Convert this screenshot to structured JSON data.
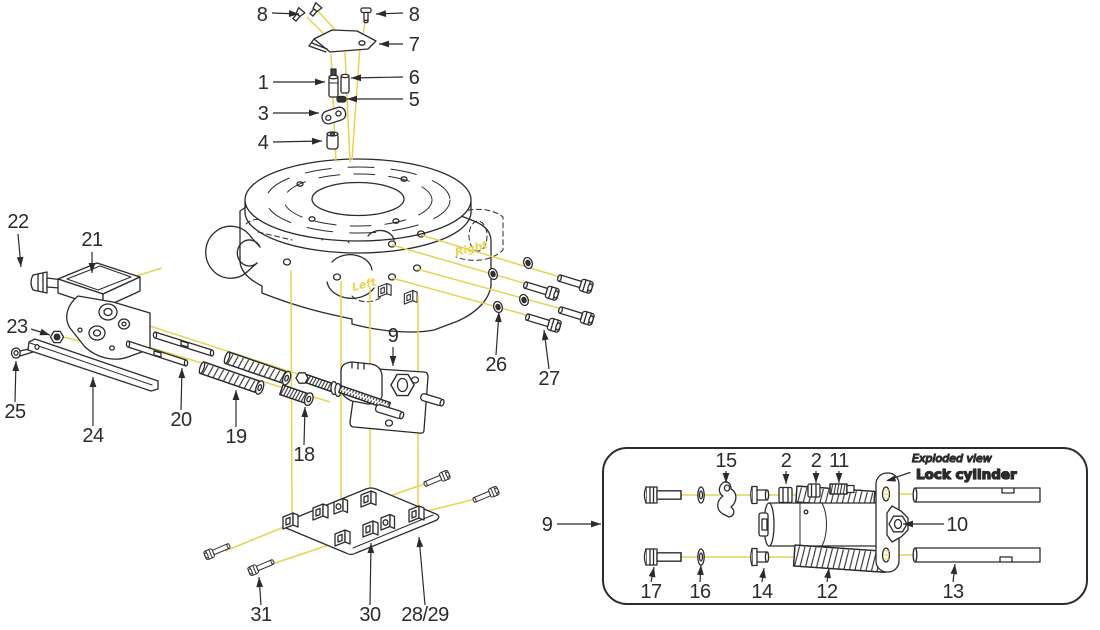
{
  "colors": {
    "ink": "#2b2b2b",
    "accent": "#e6d355"
  },
  "annotations": {
    "exploded_view": "Exploded view",
    "lock_cylinder": "Lock cylinder",
    "right": "Right",
    "left": "Left"
  },
  "part_labels": [
    {
      "text": "8",
      "tx": 262,
      "ty": 21,
      "lx": 272,
      "ly": 13,
      "ax": 299,
      "ay": 14
    },
    {
      "text": "8",
      "tx": 414,
      "ty": 21,
      "lx": 403,
      "ly": 13,
      "ax": 376,
      "ay": 14
    },
    {
      "text": "7",
      "tx": 414,
      "ty": 51,
      "lx": 403,
      "ly": 44,
      "ax": 379,
      "ay": 44
    },
    {
      "text": "1",
      "tx": 263,
      "ty": 89,
      "lx": 273,
      "ly": 82,
      "ax": 325,
      "ay": 82
    },
    {
      "text": "6",
      "tx": 414,
      "ty": 84,
      "lx": 403,
      "ly": 77,
      "ax": 351,
      "ay": 78
    },
    {
      "text": "5",
      "tx": 414,
      "ty": 106,
      "lx": 403,
      "ly": 99,
      "ax": 347,
      "ay": 99
    },
    {
      "text": "3",
      "tx": 263,
      "ty": 120,
      "lx": 273,
      "ly": 113,
      "ax": 319,
      "ay": 113
    },
    {
      "text": "4",
      "tx": 263,
      "ty": 149,
      "lx": 273,
      "ly": 142,
      "ax": 322,
      "ay": 141
    },
    {
      "text": "22",
      "tx": 18,
      "ty": 228,
      "lx": 18,
      "ly": 234,
      "ax": 21,
      "ay": 267
    },
    {
      "text": "21",
      "tx": 92,
      "ty": 246,
      "lx": 92,
      "ly": 252,
      "ax": 92,
      "ay": 273
    },
    {
      "text": "23",
      "tx": 17,
      "ty": 333,
      "lx": 31,
      "ly": 329,
      "ax": 50,
      "ay": 335
    },
    {
      "text": "25",
      "tx": 15,
      "ty": 418,
      "lx": 15,
      "ly": 402,
      "ax": 16,
      "ay": 361
    },
    {
      "text": "24",
      "tx": 93,
      "ty": 442,
      "lx": 93,
      "ly": 426,
      "ax": 93,
      "ay": 377
    },
    {
      "text": "20",
      "tx": 181,
      "ty": 426,
      "lx": 181,
      "ly": 410,
      "ax": 182,
      "ay": 368
    },
    {
      "text": "19",
      "tx": 236,
      "ty": 443,
      "lx": 236,
      "ly": 427,
      "ax": 236,
      "ay": 390
    },
    {
      "text": "18",
      "tx": 304,
      "ty": 461,
      "lx": 304,
      "ly": 445,
      "ax": 305,
      "ay": 407
    },
    {
      "text": "9",
      "tx": 393,
      "ty": 342,
      "lx": 393,
      "ly": 347,
      "ax": 393,
      "ay": 366
    },
    {
      "text": "26",
      "tx": 496,
      "ty": 371,
      "lx": 496,
      "ly": 355,
      "ax": 499,
      "ay": 312
    },
    {
      "text": "27",
      "tx": 549,
      "ty": 385,
      "lx": 549,
      "ly": 369,
      "ax": 544,
      "ay": 330
    },
    {
      "text": "31",
      "tx": 261,
      "ty": 621,
      "lx": 261,
      "ly": 605,
      "ax": 259,
      "ay": 577
    },
    {
      "text": "30",
      "tx": 370,
      "ty": 621,
      "lx": 370,
      "ly": 605,
      "ax": 371,
      "ay": 543
    },
    {
      "text": "28/29",
      "tx": 425,
      "ty": 621,
      "lx": 425,
      "ly": 605,
      "ax": 419,
      "ay": 537
    },
    {
      "text": "9",
      "tx": 547,
      "ty": 531,
      "lx": 557,
      "ly": 524,
      "ax": 601,
      "ay": 524
    },
    {
      "text": "15",
      "tx": 726,
      "ty": 467,
      "lx": 726,
      "ly": 471,
      "ax": 726,
      "ay": 483
    },
    {
      "text": "2",
      "tx": 786,
      "ty": 467,
      "lx": 786,
      "ly": 471,
      "ax": 786,
      "ay": 484
    },
    {
      "text": "2",
      "tx": 816,
      "ty": 467,
      "lx": 816,
      "ly": 471,
      "ax": 816,
      "ay": 483
    },
    {
      "text": "11",
      "tx": 839,
      "ty": 467,
      "lx": 839,
      "ly": 471,
      "ax": 839,
      "ay": 483
    },
    {
      "text": "10",
      "tx": 957,
      "ty": 531,
      "lx": 944,
      "ly": 524,
      "ax": 903,
      "ay": 524
    },
    {
      "text": "17",
      "tx": 651,
      "ty": 598,
      "lx": 651,
      "ly": 582,
      "ax": 654,
      "ay": 567
    },
    {
      "text": "16",
      "tx": 700,
      "ty": 598,
      "lx": 700,
      "ly": 582,
      "ax": 701,
      "ay": 565
    },
    {
      "text": "14",
      "tx": 762,
      "ty": 598,
      "lx": 762,
      "ly": 582,
      "ax": 764,
      "ay": 568
    },
    {
      "text": "12",
      "tx": 827,
      "ty": 598,
      "lx": 827,
      "ly": 582,
      "ax": 829,
      "ay": 568
    },
    {
      "text": "13",
      "tx": 953,
      "ty": 598,
      "lx": 953,
      "ly": 582,
      "ax": 955,
      "ay": 564
    }
  ]
}
